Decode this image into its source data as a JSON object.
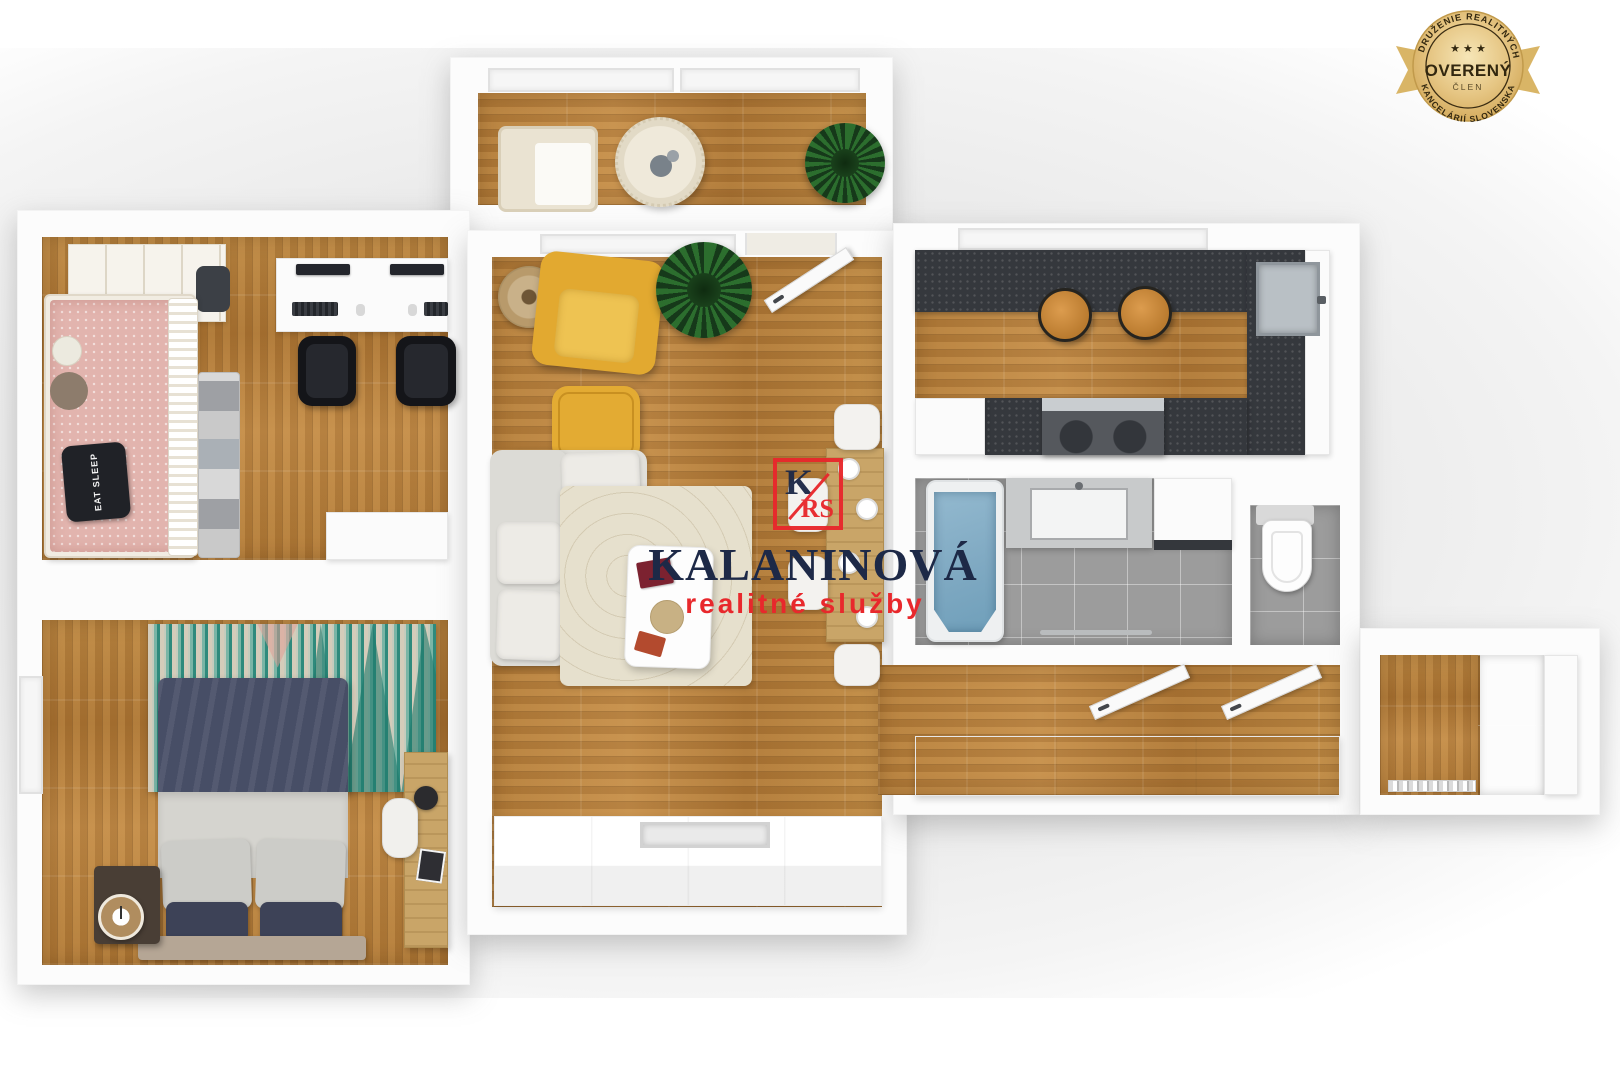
{
  "brand": {
    "monogram_k": "K",
    "monogram_rs": "RS",
    "name": "KALANINOVÁ",
    "tagline": "realitné služby"
  },
  "badge": {
    "arc_top": "ZDRUŽENIE REALITNÝCH",
    "stars": "★ ★ ★",
    "title": "OVERENÝ",
    "subtitle": "ČLEN",
    "arc_bottom": "KANCELÁRIÍ SLOVENSKA"
  },
  "floorplan": {
    "view": "3d-top-down-apartment-render",
    "decor_text": {
      "pillow": "EAT SLEEP"
    },
    "rooms": [
      {
        "name": "balcony",
        "furniture": [
          "wicker-bench",
          "round-table",
          "potted-plant",
          "window"
        ]
      },
      {
        "name": "kids-bedroom",
        "furniture": [
          "pink-single-bed",
          "plush-toys",
          "black-pillow",
          "blanket-stack",
          "wall-shelf",
          "double-desk",
          "monitor",
          "monitor",
          "keyboard",
          "keyboard",
          "office-chair",
          "office-chair",
          "cabinet"
        ]
      },
      {
        "name": "master-bedroom",
        "furniture": [
          "navy-double-bed",
          "gray-pillows",
          "navy-pillows",
          "zigzag-rug",
          "nightstand",
          "alarm-clock",
          "desk",
          "chair",
          "table-lamp",
          "window"
        ]
      },
      {
        "name": "living-room",
        "furniture": [
          "yellow-armchair",
          "floor-lamp",
          "yellow-ottoman",
          "potted-plant",
          "corner-sofa",
          "cushions",
          "area-rug",
          "coffee-table",
          "books",
          "dining-table",
          "dining-chairs",
          "plates",
          "tv-sideboard",
          "open-balcony-door",
          "window"
        ]
      },
      {
        "name": "kitchen",
        "furniture": [
          "u-shaped-dark-counter",
          "stainless-sink",
          "cooktop-oven",
          "fridge",
          "tall-cabinet",
          "bar-stool",
          "bar-stool",
          "window"
        ]
      },
      {
        "name": "bathroom",
        "furniture": [
          "bathtub",
          "vanity-sink",
          "washing-machine",
          "towel-rail"
        ]
      },
      {
        "name": "wc",
        "furniture": [
          "wall-hung-toilet",
          "cistern"
        ]
      },
      {
        "name": "hallway",
        "furniture": [
          "long-sideboard",
          "open-door",
          "open-door"
        ]
      },
      {
        "name": "storage-room",
        "furniture": [
          "wardrobe",
          "gray-cabinet",
          "door-sill"
        ]
      }
    ]
  },
  "colors": {
    "wall": "#fcfcfc",
    "wood": "#b5813f",
    "counter": "#35383d",
    "tile": "#9c9c9c",
    "water": "#7fa9c2",
    "yellow": "#e2a930",
    "sofa-c": "#e0dfda",
    "pink": "#e2b4ae",
    "navy": "#474e66",
    "rug-teal": "#2f8a7c",
    "rug-cream": "#d5ccba",
    "red": "#e8282c",
    "navy-text": "#1d2947",
    "gold": "#d9b566",
    "gold-light": "#f3e0ab",
    "badge-text": "#32270f"
  }
}
